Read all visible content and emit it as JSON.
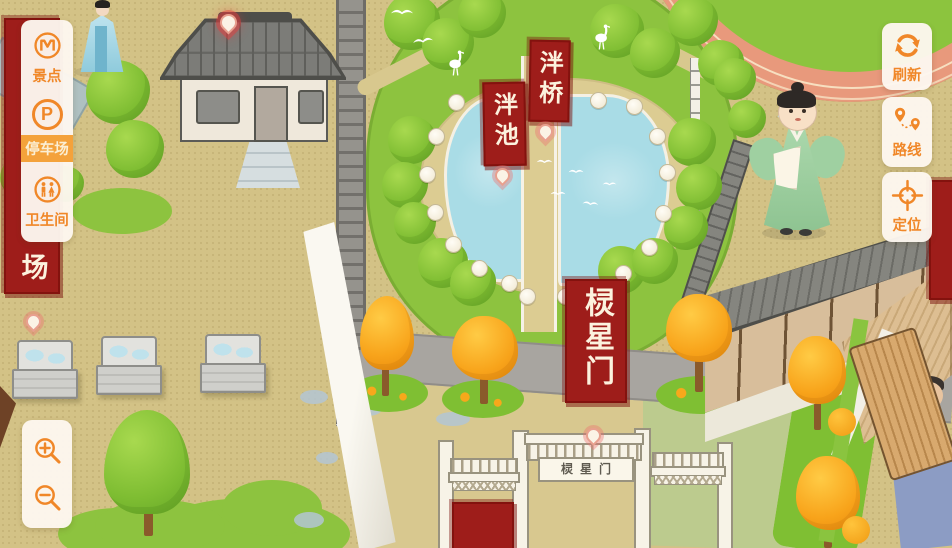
{
  "sidebar": {
    "items": [
      {
        "label": "景点",
        "icon": "scenic-icon",
        "active": false
      },
      {
        "label": "停车场",
        "icon": "parking-icon",
        "active": true
      },
      {
        "label": "卫生间",
        "icon": "restroom-icon",
        "active": false
      }
    ]
  },
  "toolbar": {
    "items": [
      {
        "label": "刷新",
        "icon": "refresh-icon"
      },
      {
        "label": "路线",
        "icon": "route-icon"
      },
      {
        "label": "定位",
        "icon": "locate-icon"
      }
    ]
  },
  "zoom_controls": {
    "zoom_in_icon": "magnifier-plus-icon",
    "zoom_out_icon": "magnifier-minus-icon"
  },
  "map": {
    "banners": {
      "pan_bridge": "泮桥",
      "pan_pond": "泮池",
      "lingxing_gate": "棂星门",
      "left_edge_partial": "场",
      "bottom_partial": "",
      "right_edge_partial": ""
    },
    "plaques": {
      "lingxing_gate": "棂星门"
    },
    "parking_icon_letter": "P"
  },
  "colors": {
    "accent_orange": "#F08728",
    "active_bg": "#F4A23B",
    "active_text": "#FBEFD4",
    "banner_red": "#9E1D1A",
    "banner_text": "#FCF2DE",
    "panel_bg": "#FDF7EF",
    "pond_blue": "#A9DCE6",
    "grass_green": "#8DC33F",
    "ground_tan": "#D3C286",
    "track_salmon": "#E8997C"
  }
}
